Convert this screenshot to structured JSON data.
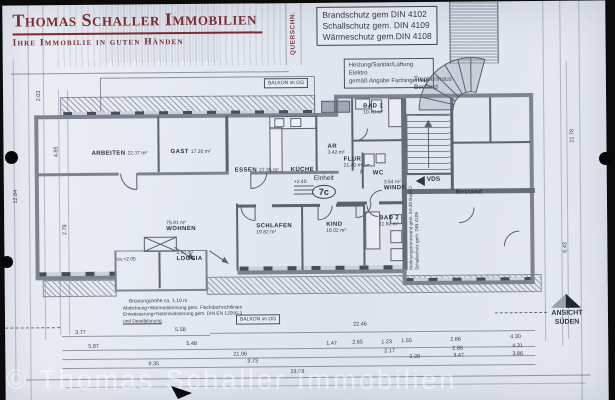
{
  "branding": {
    "company": "Thomas Schaller Immobilien",
    "tagline": "Ihre Immobilie in guten Händen",
    "brand_color": "#7c2b33"
  },
  "watermark": "© Thomas Schaller Immobilien",
  "header_notes": {
    "querschnitt": "QUERSCHN.",
    "din_lines": [
      "Brandschutz gem DIN 4102",
      "Schallschutz gem. DIN 4109",
      "Wärmeschutz gem.DIN 4108"
    ],
    "fach_lines": [
      "Heizung/Sanitär/Lüftung",
      "Elektro",
      "gemäß Angabe Fachingenieur"
    ]
  },
  "plan": {
    "unit": {
      "label": "Einheit",
      "number": "7c"
    },
    "stairwell": [
      "Treppenhaus",
      "Bestand"
    ],
    "balkon_top": "BALKON im OG",
    "balkon_bottom": "BALKON im OG",
    "bruestung": "Brüstungshöhe ca. 1.10 m",
    "abdichtung_lines": [
      "Abdichtung+Wärmedämmung gem. Flachdachrichtlinien",
      "Entwässerung+Notentwässerung gem. DIN EN 12056-3",
      "und Detailplanung"
    ],
    "wall_note": [
      "Wohnungstrennwand gem. Art.30 BayBO",
      "Schallschutz gem. DIN 4109"
    ],
    "ansicht": [
      "ANSICHT",
      "SÜDEN"
    ],
    "vds": "VDS",
    "rooms": [
      {
        "name": "ARBEITEN",
        "area": "22.37 m²",
        "layout": "inline",
        "x": 88,
        "y": 137
      },
      {
        "name": "GAST",
        "area": "17.20 m²",
        "layout": "inline",
        "x": 167,
        "y": 136
      },
      {
        "name": "ESSEN",
        "area": "27.35 m²",
        "layout": "inline",
        "x": 231,
        "y": 155
      },
      {
        "name": "KÜCHE",
        "area": "",
        "layout": "only",
        "x": 287,
        "y": 155
      },
      {
        "name": "AR",
        "area": "3.42 m²",
        "layout": "stack",
        "x": 324,
        "y": 141
      },
      {
        "name": "FLUR",
        "area": "21.40 m²",
        "layout": "stack",
        "x": 340,
        "y": 154
      },
      {
        "name": "BAD 1",
        "area": "10.70 m²",
        "layout": "stack",
        "x": 360,
        "y": 101
      },
      {
        "name": "WC",
        "area": "",
        "layout": "only",
        "x": 369,
        "y": 159
      },
      {
        "name": "WINDF.",
        "area": "3.54 m²",
        "layout": "above",
        "x": 380,
        "y": 177
      },
      {
        "name": "BAD 2",
        "area": "11.82 m²",
        "layout": "stack",
        "x": 375,
        "y": 213
      },
      {
        "name": "KIND",
        "area": "16.02 m²",
        "layout": "stack",
        "x": 322,
        "y": 219
      },
      {
        "name": "SCHLAFEN",
        "area": "19.82 m²",
        "layout": "stack",
        "x": 252,
        "y": 220
      },
      {
        "name": "WOHNEN",
        "area": "75.91 m²",
        "layout": "above",
        "x": 162,
        "y": 216
      },
      {
        "name": "LOGGIA",
        "area": "4.70 m²",
        "layout": "above",
        "x": 172,
        "y": 246
      },
      {
        "name": "Bestand",
        "area": "",
        "layout": "only",
        "x": 452,
        "y": 179
      }
    ],
    "levels": [
      {
        "v": "+2.40",
        "x": 290,
        "y": 176
      },
      {
        "v": "ca.+2.05",
        "x": 112,
        "y": 252
      }
    ],
    "dims_bottom": [
      {
        "v": "3.77",
        "x": 70,
        "y": 325
      },
      {
        "v": "5.58",
        "x": 170,
        "y": 323
      },
      {
        "v": "22.46",
        "x": 348,
        "y": 319
      },
      {
        "v": "5.87",
        "x": 83,
        "y": 339
      },
      {
        "v": "5.48",
        "x": 181,
        "y": 337
      },
      {
        "v": "1.47",
        "x": 321,
        "y": 338
      },
      {
        "v": "2.65",
        "x": 347,
        "y": 337
      },
      {
        "v": "1.23",
        "x": 376,
        "y": 337
      },
      {
        "v": "1.55",
        "x": 396,
        "y": 336
      },
      {
        "v": "2.86",
        "x": 445,
        "y": 335
      },
      {
        "v": "4.30",
        "x": 505,
        "y": 333
      },
      {
        "v": "21.06",
        "x": 228,
        "y": 348
      },
      {
        "v": "2.17",
        "x": 379,
        "y": 346
      },
      {
        "v": "2.86",
        "x": 447,
        "y": 344
      },
      {
        "v": "4.31",
        "x": 507,
        "y": 342
      },
      {
        "v": "9.35",
        "x": 143,
        "y": 357
      },
      {
        "v": "3.73",
        "x": 242,
        "y": 355
      },
      {
        "v": "3.28",
        "x": 404,
        "y": 352
      },
      {
        "v": "3.47",
        "x": 448,
        "y": 351
      },
      {
        "v": "3.86",
        "x": 507,
        "y": 350
      },
      {
        "v": "23.98",
        "x": 285,
        "y": 366
      }
    ],
    "dims_left": [
      {
        "v": "2.03",
        "x": 33,
        "y": 96
      },
      {
        "v": "4.85",
        "x": 50,
        "y": 152
      },
      {
        "v": "2.78",
        "x": 58,
        "y": 230
      },
      {
        "v": "12.84",
        "x": 9,
        "y": 198
      }
    ],
    "dims_right": [
      {
        "v": "21.78",
        "x": 566,
        "y": 142
      },
      {
        "v": "6.43",
        "x": 558,
        "y": 252
      }
    ]
  }
}
